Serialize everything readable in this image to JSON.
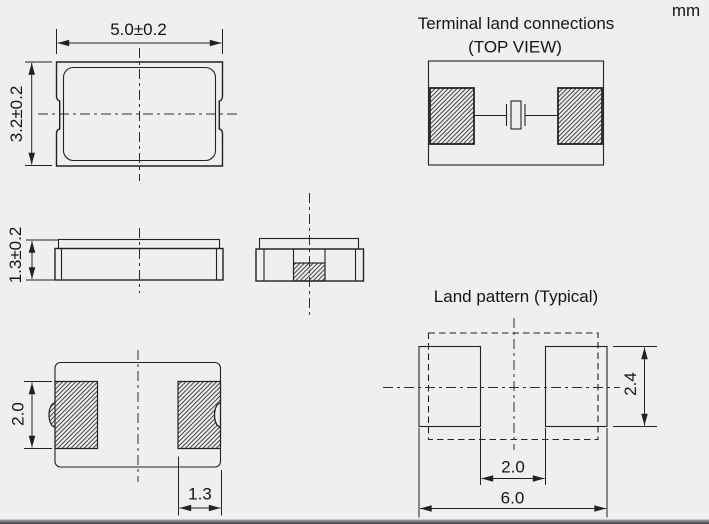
{
  "unit": "mm",
  "top_view": {
    "width_dim": "5.0±0.2",
    "height_dim": "3.2±0.2"
  },
  "side_view": {
    "thickness_dim": "1.3±0.2"
  },
  "bottom_view": {
    "pad_length_dim": "2.0",
    "pad_width_dim": "1.3"
  },
  "terminal_connections": {
    "title": "Terminal land connections",
    "subtitle": "(TOP VIEW)"
  },
  "land_pattern": {
    "title": "Land pattern (Typical)",
    "pad_height_dim": "2.4",
    "pad_gap_dim": "2.0",
    "overall_width_dim": "6.0"
  },
  "colors": {
    "background": "#efefef",
    "line": "#222222",
    "text": "#14141c"
  }
}
